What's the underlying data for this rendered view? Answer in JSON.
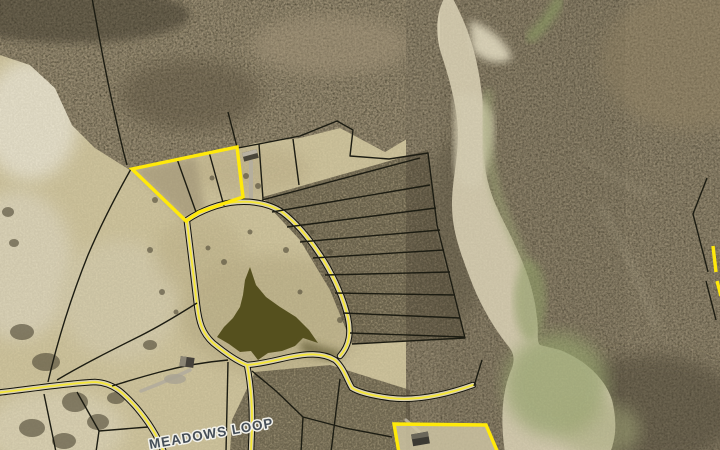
{
  "map": {
    "road_label": "MEADOWS LOOP",
    "colors": {
      "highlight": "#ffe90a",
      "parcel_line": "#1c1c12",
      "road_fill": "#d9d0b0",
      "road_casing": "#11110c",
      "road_centerline": "#f4e636",
      "field": "#d3c8a0",
      "woods": "#8a7c63",
      "woods_dark_speckle": "#3f3a2c",
      "creek_sand": "#d5ccb0",
      "creek_water": "#9aa871",
      "pond": "#55501e",
      "label_text": "#454e58",
      "label_halo": "#f2f1ea"
    }
  }
}
